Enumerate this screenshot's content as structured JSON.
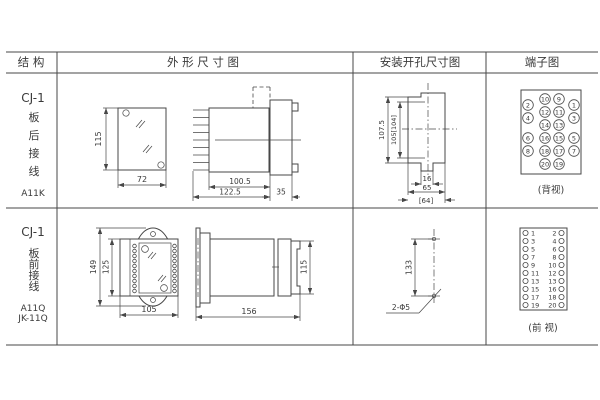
{
  "page": {
    "bg": "#ffffff",
    "line_color": "#474747",
    "text_color": "#3a3a3a"
  },
  "headers": {
    "structure": "结 构",
    "outline": "外 形 尺 寸 图",
    "install": "安装开孔尺寸图",
    "terminal": "端子图"
  },
  "row1": {
    "model": "CJ-1",
    "chars": [
      "板",
      "后",
      "接",
      "线"
    ],
    "code": "A11K",
    "dims": {
      "front_h": "115",
      "front_w": "72",
      "side_depth": "100.5",
      "side_total": "122.5",
      "side_flange": "35",
      "install_h_outer": "107.5",
      "install_h_inner": "105[104]",
      "install_notch": "16",
      "install_w": "65",
      "install_w_alt": "[64]"
    },
    "terminal": {
      "inner_pairs": [
        [
          "10",
          "9"
        ],
        [
          "12",
          "11"
        ],
        [
          "14",
          "13"
        ],
        [
          "16",
          "15"
        ],
        [
          "18",
          "17"
        ],
        [
          "20",
          "19"
        ]
      ],
      "outer_left": [
        "2",
        "4",
        "6",
        "8"
      ],
      "outer_right": [
        "1",
        "3",
        "5",
        "7"
      ],
      "view_label": "(背视)"
    }
  },
  "row2": {
    "model": "CJ-1",
    "chars": [
      "板",
      "前",
      "接",
      "线"
    ],
    "codes": [
      "A11Q",
      "JK-11Q"
    ],
    "dims": {
      "front_h_outer": "149",
      "front_h_inner": "125",
      "front_w": "105",
      "side_len": "156",
      "side_h": "115",
      "install_pitch": "133",
      "install_holes": "2-Φ5"
    },
    "terminal": {
      "pairs": [
        [
          "1",
          "2"
        ],
        [
          "3",
          "4"
        ],
        [
          "5",
          "6"
        ],
        [
          "7",
          "8"
        ],
        [
          "9",
          "10"
        ],
        [
          "11",
          "12"
        ],
        [
          "13",
          "13"
        ],
        [
          "15",
          "16"
        ],
        [
          "17",
          "18"
        ],
        [
          "19",
          "20"
        ]
      ],
      "view_label": "(前 视)"
    }
  }
}
